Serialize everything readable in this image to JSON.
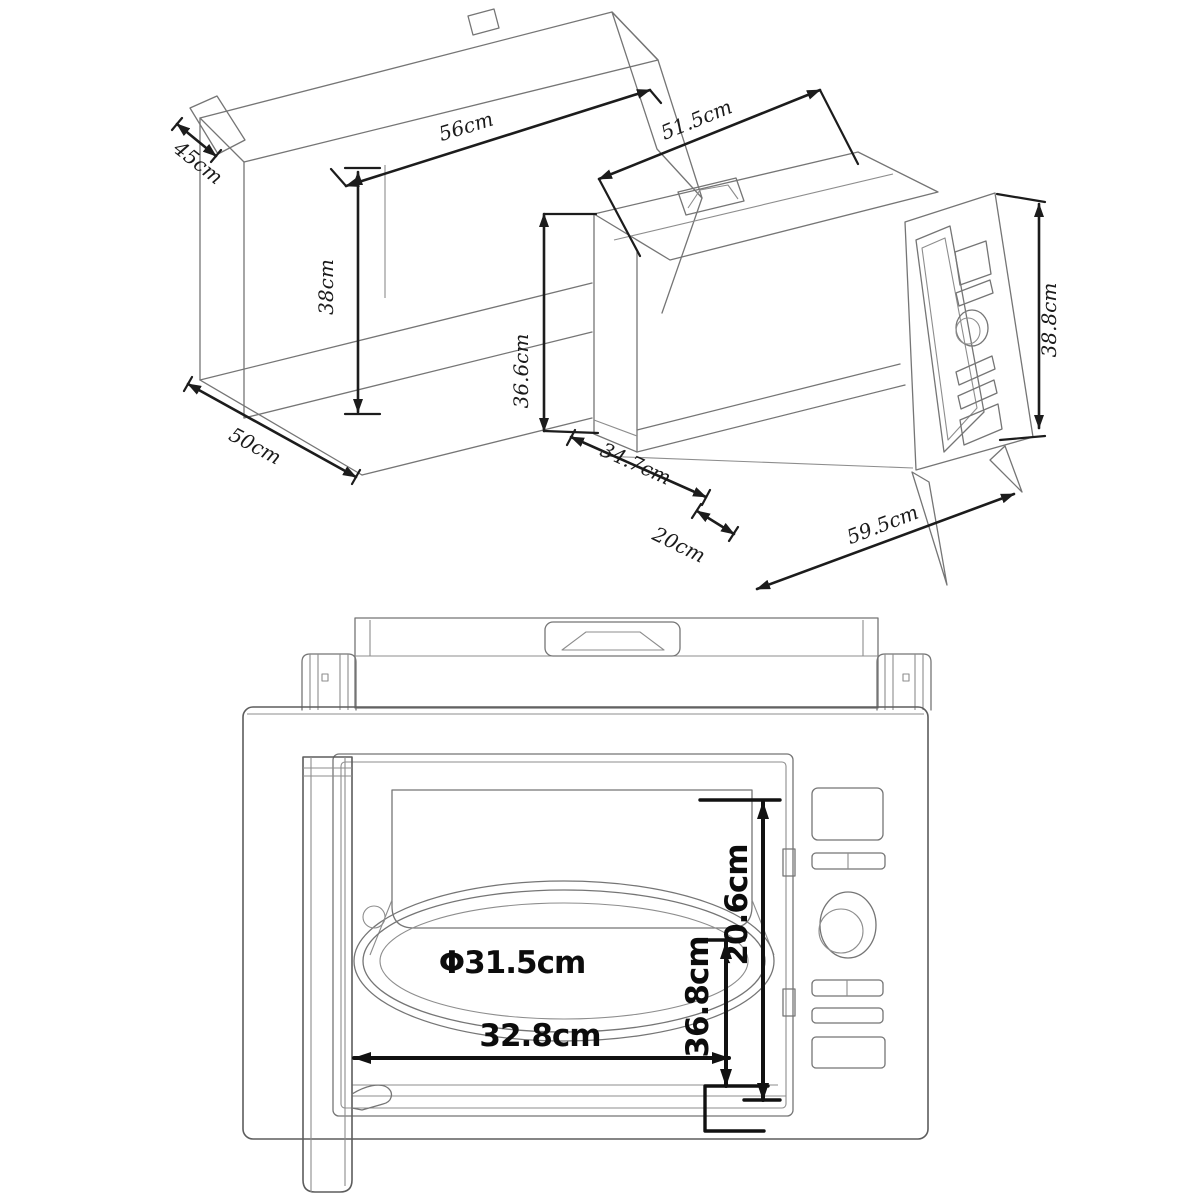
{
  "figure": {
    "type": "technical-dimension-drawing",
    "subject": "built-in microwave oven installation dimensions",
    "background": "#ffffff",
    "line_color": "#757575",
    "dimension_color": "#111111"
  },
  "iso": {
    "cabinet": {
      "depth_top": "45cm",
      "width": "56cm",
      "height": "38cm",
      "depth_bottom": "50cm"
    },
    "oven": {
      "body_width": "51.5cm",
      "body_height": "36.6cm",
      "body_depth": "34.7cm",
      "overhang": "20cm",
      "frame_width": "59.5cm",
      "frame_height": "38.8cm"
    }
  },
  "front": {
    "turntable": "Φ31.5cm",
    "inner_height": "20.6cm",
    "inner_depth": "36.8cm",
    "inner_width": "32.8cm"
  }
}
